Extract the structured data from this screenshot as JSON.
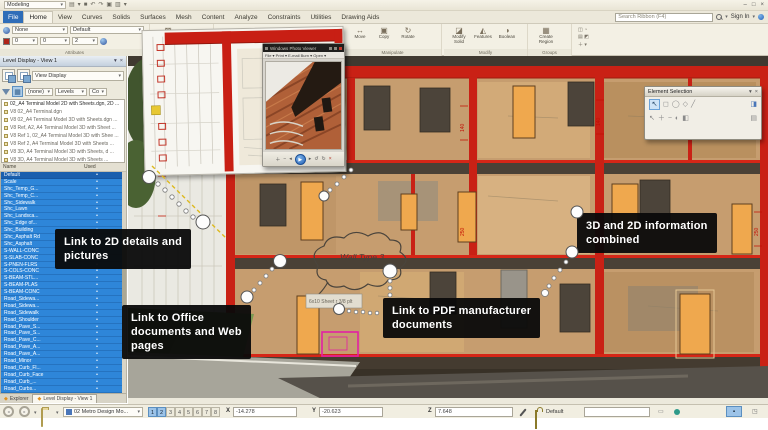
{
  "titlebar": {
    "workflow": "Modeling",
    "quick_icons": [
      "▤",
      "▾",
      "■",
      "↶",
      "↷",
      "▣",
      "▥",
      "▾"
    ],
    "window_controls": [
      "–",
      "□",
      "×"
    ]
  },
  "tab_row": {
    "tabs": [
      {
        "label": "File",
        "kind": "file"
      },
      {
        "label": "Home",
        "active": true
      },
      {
        "label": "View"
      },
      {
        "label": "Curves"
      },
      {
        "label": "Solids"
      },
      {
        "label": "Surfaces"
      },
      {
        "label": "Mesh"
      },
      {
        "label": "Content"
      },
      {
        "label": "Analyze"
      },
      {
        "label": "Constraints"
      },
      {
        "label": "Utilities"
      },
      {
        "label": "Drawing Aids"
      }
    ],
    "search_placeholder": "Search Ribbon (F4)",
    "sign_in": "Sign In"
  },
  "ribbon": {
    "attributes": {
      "label": "Attributes",
      "element_class": "None",
      "level": "Default",
      "color": "0",
      "style": "0",
      "weight": "2"
    },
    "placement": {
      "label": "Placement",
      "tool_icon": "▩",
      "tool_label": "Fence\nTools"
    },
    "manipulate": {
      "label": "Manipulate",
      "tools": [
        {
          "icon": "↔",
          "label": "Move"
        },
        {
          "icon": "▣",
          "label": "Copy"
        },
        {
          "icon": "↻",
          "label": "Rotate"
        }
      ]
    },
    "modify": {
      "label": "Modify",
      "tools": [
        {
          "icon": "◪",
          "label": "Modify\nSolid"
        },
        {
          "icon": "◭",
          "label": "Features"
        },
        {
          "icon": "◑",
          "label": "Boolean"
        }
      ]
    },
    "groups": {
      "label": "Groups",
      "tools": [
        {
          "icon": "▦",
          "label": "Create\nRegion"
        }
      ]
    },
    "selection_stack": [
      "◫ ◔",
      "▤ ◩",
      "＋ ▾"
    ]
  },
  "level_display": {
    "title": "Level Display - View 1",
    "view_display": "View Display",
    "filter": "(none)",
    "levels_btn": "Levels",
    "col_btn": "Co",
    "tree": [
      {
        "label": "02_A4 Terminal Model 2D with Sheets.dgn, 2D ...",
        "kind": "root"
      },
      {
        "label": "V8 02_A4 Terminal.dgn"
      },
      {
        "label": "V8 02_A4 Terminal Model 3D with Sheets.dgn ..."
      },
      {
        "label": "V8 Ref, A2, A4 Terminal Model 3D with Sheet ..."
      },
      {
        "label": "V8 Ref 1, 02_A4 Terminal Model 3D with Shee ..."
      },
      {
        "label": "V8 Ref 2, A4 Terminal Model 3D with Sheets ..."
      },
      {
        "label": "V8 3D, A4 Terminal Model 3D with Sheets, d ..."
      },
      {
        "label": "V8 3D, A4 Terminal Model 3D with Sheets ..."
      }
    ],
    "columns": {
      "name": "Name",
      "used": "Used"
    },
    "levels": [
      {
        "name": "Default",
        "used": "•",
        "kind": "default"
      },
      {
        "name": "Scale",
        "used": "•"
      },
      {
        "name": "Shc_Temp_G...",
        "used": "•"
      },
      {
        "name": "Shc_Temp_C...",
        "used": "•"
      },
      {
        "name": "Shc_Sidewalk",
        "used": "•"
      },
      {
        "name": "Shc_Lawn",
        "used": "•"
      },
      {
        "name": "Shc_Landsca...",
        "used": "•"
      },
      {
        "name": "Shc_Edge of...",
        "used": "•"
      },
      {
        "name": "Shc_Building",
        "used": "•"
      },
      {
        "name": "Shc_Asphalt Rd",
        "used": "•"
      },
      {
        "name": "Shc_Asphalt",
        "used": "•"
      },
      {
        "name": "S-WALL-CONC",
        "used": "•"
      },
      {
        "name": "S-SLAB-CONC",
        "used": "•"
      },
      {
        "name": "S-PNEN-FLRS",
        "used": "•"
      },
      {
        "name": "S-COLS-CONC",
        "used": "•"
      },
      {
        "name": "S-BEAM-STL...",
        "used": "•"
      },
      {
        "name": "S-BEAM-PLAS",
        "used": "•"
      },
      {
        "name": "S-BEAM-CONC",
        "used": "•"
      },
      {
        "name": "Road_Sidewa...",
        "used": "•"
      },
      {
        "name": "Road_Sidewa...",
        "used": "•"
      },
      {
        "name": "Road_Sidewalk",
        "used": "•"
      },
      {
        "name": "Road_Shoulder",
        "used": "•"
      },
      {
        "name": "Road_Pave_S...",
        "used": "•"
      },
      {
        "name": "Road_Pave_S...",
        "used": "•"
      },
      {
        "name": "Road_Pave_C...",
        "used": "•"
      },
      {
        "name": "Road_Pave_A...",
        "used": "•"
      },
      {
        "name": "Road_Pave_A...",
        "used": "•"
      },
      {
        "name": "Road_Minor",
        "used": "•"
      },
      {
        "name": "Road_Curb_Fl...",
        "used": "•"
      },
      {
        "name": "Road_Curb_Face",
        "used": "•"
      },
      {
        "name": "Road_Curb_...",
        "used": "•"
      },
      {
        "name": "Road_Curbs...",
        "used": "•"
      }
    ],
    "tabs": [
      {
        "label": "Explorer"
      },
      {
        "label": "Level Display - View 1",
        "active": true
      }
    ]
  },
  "status_bar": {
    "view_group": "02 Metro Design Mo...",
    "toggles": [
      {
        "label": "1",
        "active": true
      },
      {
        "label": "2",
        "active": true
      },
      {
        "label": "3"
      },
      {
        "label": "4"
      },
      {
        "label": "5"
      },
      {
        "label": "6"
      },
      {
        "label": "7"
      },
      {
        "label": "8"
      }
    ],
    "x_label": "X",
    "x_value": "-14.278",
    "y_label": "Y",
    "y_value": "-20.623",
    "z_label": "Z",
    "z_value": "7.648",
    "active_level": "Default"
  },
  "callouts": {
    "details": "Link to 2D details and\npictures",
    "office": "Link to Office\ndocuments and Web\npages",
    "pdf": "Link to PDF manufacturer\ndocuments",
    "combined": "3D and 2D information\ncombined"
  },
  "photo_viewer": {
    "title": "Windows Photo Viewer",
    "menu": "File ▾    Print ▾    E-mail    Burn ▾    Open ▾"
  },
  "element_selection": {
    "title": "Element Selection"
  },
  "scene": {
    "wall_label": "Wall Type 3",
    "sheet_note": "6x10 Sheet r 3/8 plt",
    "dims": [
      "140",
      "250",
      "140",
      "250"
    ]
  },
  "colors": {
    "accent_red": "#c92115",
    "select_blue": "#2e86d9",
    "callout_bg": "#0a0a0a"
  }
}
